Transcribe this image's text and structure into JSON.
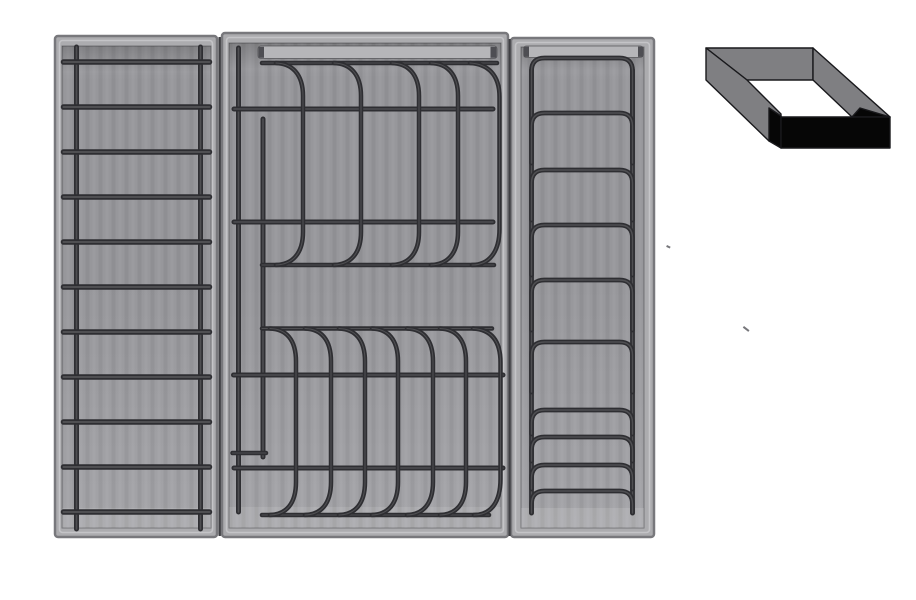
{
  "colors": {
    "bg": "#ffffff",
    "rim": "#acacaf",
    "rim-edge": "#78787c",
    "rim-highlight": "#c4c4c7",
    "floor-a": "#a4a4a8",
    "floor-b": "#97979b",
    "floor-c": "#a2a2a6",
    "wire": "#2e2e32",
    "handle": "#b6b6b9",
    "handle-cap": "#4e4e53",
    "seam": "#3f3f43",
    "icon-gray": "#7f7f82",
    "icon-black": "#060606",
    "icon-outline": "#19191c",
    "speck": "#77777b"
  },
  "scene": {
    "left_tray": {
      "label": "ladder-rack-tray",
      "rung_count": 11,
      "rung_ys": [
        62,
        107,
        152,
        197,
        242,
        287,
        332,
        377,
        422,
        467,
        512
      ],
      "rung_x1": 63.5,
      "rung_x2": 209.5,
      "shadow_x1": 80,
      "shadow_x2": 196,
      "shadow_dy": 17,
      "rod_xs": [
        76.5,
        200.5
      ],
      "rod_y1": 47,
      "rod_y2": 529
    },
    "middle_tray": {
      "label": "plate-rack-tray",
      "full_wires": [
        {
          "y": 109,
          "x1": 234,
          "x2": 493
        },
        {
          "y": 222,
          "x1": 234,
          "x2": 493
        },
        {
          "y": 375,
          "x1": 233.5,
          "x2": 503
        },
        {
          "y": 468,
          "x1": 234,
          "x2": 503
        }
      ],
      "sections": [
        {
          "top_y": 63,
          "bottom_y": 265,
          "wire_x1": 262,
          "wire_x2": 497,
          "arc_xs": [
            276,
            334,
            392,
            431
          ],
          "arc_bulge": 27,
          "tall_arc": {
            "x": 470,
            "bulge_x": 499.5,
            "foot_x": 472
          }
        },
        {
          "top_y": 328.5,
          "bottom_y": 515,
          "wire_x1": 262,
          "wire_x2": 492,
          "arc_xs": [
            270,
            305,
            339,
            372,
            407,
            440
          ],
          "arc_bulge": 26,
          "tall_arc": {
            "x": 473,
            "bulge_x": 500.5,
            "foot_x": 474
          }
        }
      ],
      "rods": [
        {
          "x": 238.5,
          "y1": 48,
          "y2": 512
        },
        {
          "x": 263,
          "y1": 119,
          "y2": 457
        }
      ],
      "short_bar": {
        "y": 453,
        "x1": 232.5,
        "x2": 266
      }
    },
    "right_tray": {
      "label": "lid-rack-tray",
      "rail_xs": [
        531.5,
        632.5
      ],
      "rail_y1": 70,
      "rail_y2": 513,
      "hoop_x1": 531.5,
      "hoop_x2": 632.5,
      "corner_r": 13,
      "hoops": [
        {
          "y": 58,
          "leg": 74
        },
        {
          "y": 113,
          "leg": 50
        },
        {
          "y": 170,
          "leg": 50
        },
        {
          "y": 225,
          "leg": 50
        },
        {
          "y": 280,
          "leg": 50
        },
        {
          "y": 342,
          "leg": 50
        },
        {
          "y": 410,
          "leg": 24
        },
        {
          "y": 437,
          "leg": 24
        },
        {
          "y": 465,
          "leg": 24
        },
        {
          "y": 491,
          "leg": 22
        }
      ]
    },
    "specks": [
      {
        "x": 667,
        "y": 245,
        "w": 4,
        "h": 2,
        "angle": 25
      },
      {
        "x": 744,
        "y": 326,
        "w": 7,
        "h": 2,
        "angle": 38
      }
    ],
    "icon": {
      "name": "rectangular-frame-isometric-icon"
    }
  }
}
